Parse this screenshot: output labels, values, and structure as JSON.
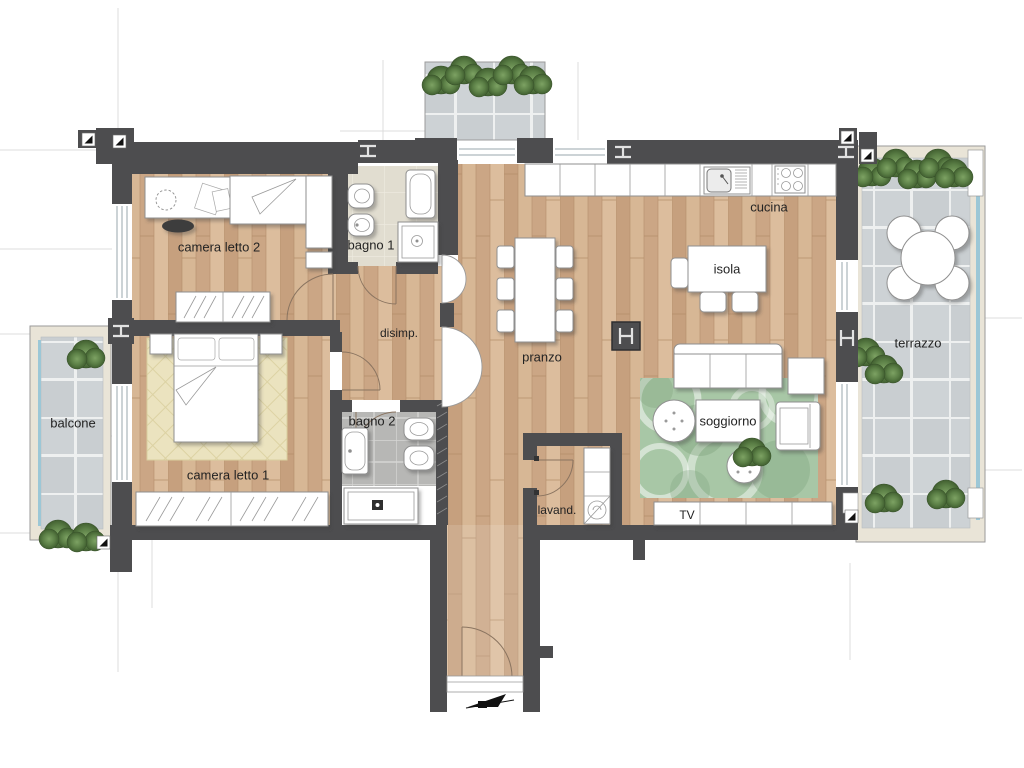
{
  "plan": {
    "type": "apartment-floor-plan",
    "labels": {
      "camera_letto_2": "camera letto 2",
      "bagno_1": "bagno 1",
      "disimp": "disimp.",
      "balcone": "balcone",
      "camera_letto_1": "camera letto 1",
      "bagno_2": "bagno 2",
      "lavand": "lavand.",
      "pranzo": "pranzo",
      "cucina": "cucina",
      "isola": "isola",
      "soggiorno": "soggiorno",
      "tv": "TV",
      "terrazzo": "terrazzo"
    },
    "colors": {
      "wall": "#4d4d4f",
      "wood_floor": "#cfad8c",
      "outdoor_tile": "#c9ced1",
      "bath1_floor": "#e1ddd0",
      "bath2_floor": "#b7b7b5",
      "rug_green": "#a8c7a6",
      "rug_cream": "#ebe3bf",
      "greenery": "#5b7f46",
      "glass_blue": "#9cc7d6"
    }
  }
}
